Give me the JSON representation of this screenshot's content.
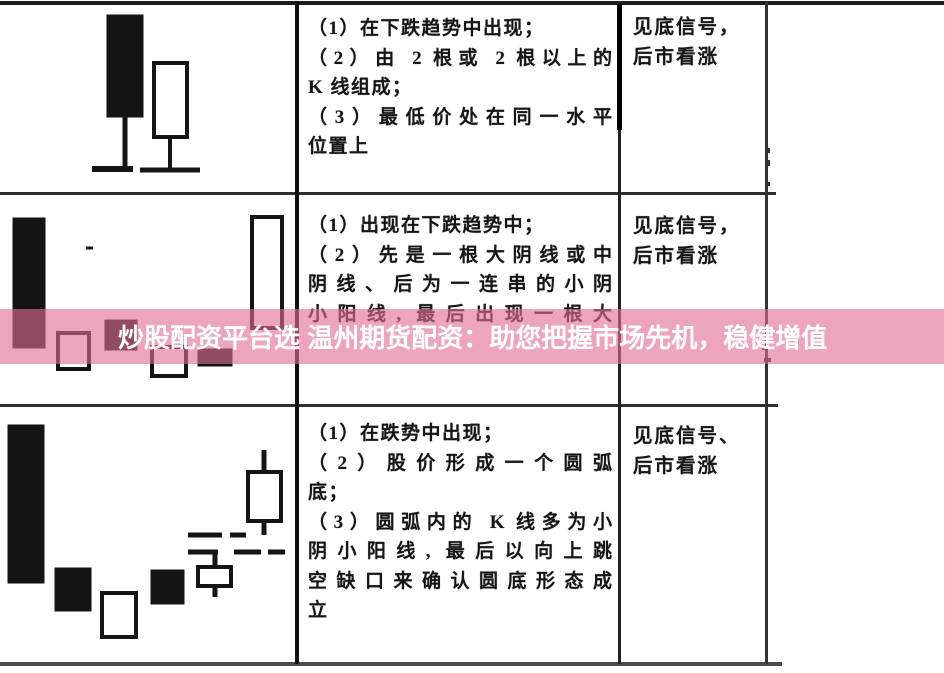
{
  "banner": {
    "text": "炒股配资平台选 温州期货配资：助您把握市场先机，稳健增值",
    "overlay_color": "rgba(226,110,148,0.62)",
    "text_color": "#ffffff"
  },
  "table": {
    "rows": [
      {
        "criteria_lines": [
          "（1）在下跌趋势中出现；",
          "（2）由 2 根或 2 根以上的",
          "K 线组成；",
          "（3）最低价处在同一水平",
          "位置上"
        ],
        "signal_lines": [
          "见底信号，",
          "后市看涨"
        ]
      },
      {
        "criteria_lines": [
          "（1）出现在下跌趋势中；",
          "（2）先是一根大阴线或中",
          "阴线、后为一连串的小阴",
          "小阳线, 最后出现一根大"
        ],
        "signal_lines": [
          "见底信号，",
          "后市看涨"
        ]
      },
      {
        "criteria_lines": [
          "（1）在跌势中出现；",
          "（2）股价形成一个圆弧",
          "底；",
          "（3）圆弧内的 K 线多为小",
          "阴小阳线, 最后以向上跳",
          "空缺口来确认圆底形态成",
          "立"
        ],
        "signal_lines": [
          "见底信号、",
          "后市看涨"
        ]
      }
    ]
  },
  "diagrams": {
    "ink_color": "#141414",
    "row1": {
      "width": 293,
      "height": 189,
      "candles": [
        {
          "x": 105,
          "y": 11,
          "w": 36,
          "h": 102,
          "t": "filled"
        },
        {
          "x": 152,
          "y": 59,
          "w": 33,
          "h": 74,
          "t": "hollow"
        }
      ],
      "wicks": [
        {
          "x": 123,
          "y1": 112,
          "y2": 164,
          "w": 5
        },
        {
          "x": 168,
          "y1": 132,
          "y2": 165,
          "w": 4
        }
      ],
      "segments": [
        {
          "x1": 90,
          "y1": 165,
          "x2": 131,
          "y2": 165,
          "w": 6
        },
        {
          "x1": 138,
          "y1": 166,
          "x2": 198,
          "y2": 166,
          "w": 5
        }
      ]
    },
    "row2": {
      "width": 293,
      "height": 211,
      "candles": [
        {
          "x": 11,
          "y": 25,
          "w": 32,
          "h": 130,
          "t": "filled"
        },
        {
          "x": 56,
          "y": 140,
          "w": 31,
          "h": 36,
          "t": "hollow"
        },
        {
          "x": 103,
          "y": 127,
          "w": 32,
          "h": 30,
          "t": "filled"
        },
        {
          "x": 150,
          "y": 154,
          "w": 34,
          "h": 29,
          "t": "hollow"
        },
        {
          "x": 196,
          "y": 156,
          "w": 34,
          "h": 17,
          "t": "filled"
        },
        {
          "x": 250,
          "y": 24,
          "w": 30,
          "h": 111,
          "t": "hollow"
        }
      ],
      "wicks": [],
      "segments": [
        {
          "x1": 84,
          "y1": 55,
          "x2": 91,
          "y2": 55,
          "w": 3
        }
      ]
    },
    "row3": {
      "width": 293,
      "height": 260,
      "candles": [
        {
          "x": 6,
          "y": 21,
          "w": 36,
          "h": 158,
          "t": "filled"
        },
        {
          "x": 53,
          "y": 164,
          "w": 36,
          "h": 43,
          "t": "filled"
        },
        {
          "x": 100,
          "y": 189,
          "w": 34,
          "h": 44,
          "t": "hollow"
        },
        {
          "x": 149,
          "y": 166,
          "w": 33,
          "h": 34,
          "t": "filled"
        },
        {
          "x": 196,
          "y": 163,
          "w": 33,
          "h": 19,
          "t": "hollow"
        },
        {
          "x": 246,
          "y": 68,
          "w": 33,
          "h": 49,
          "t": "hollow"
        }
      ],
      "wicks": [
        {
          "x": 213,
          "y1": 149,
          "y2": 163,
          "w": 5
        },
        {
          "x": 213,
          "y1": 182,
          "y2": 193,
          "w": 5
        },
        {
          "x": 262,
          "y1": 46,
          "y2": 68,
          "w": 5
        },
        {
          "x": 262,
          "y1": 117,
          "y2": 131,
          "w": 5
        }
      ],
      "segments": [
        {
          "x1": 186,
          "y1": 131,
          "x2": 220,
          "y2": 131,
          "w": 5
        },
        {
          "x1": 228,
          "y1": 131,
          "x2": 244,
          "y2": 131,
          "w": 5
        },
        {
          "x1": 186,
          "y1": 148,
          "x2": 216,
          "y2": 148,
          "w": 5
        },
        {
          "x1": 232,
          "y1": 148,
          "x2": 259,
          "y2": 148,
          "w": 5
        },
        {
          "x1": 266,
          "y1": 148,
          "x2": 283,
          "y2": 148,
          "w": 5
        }
      ]
    }
  }
}
